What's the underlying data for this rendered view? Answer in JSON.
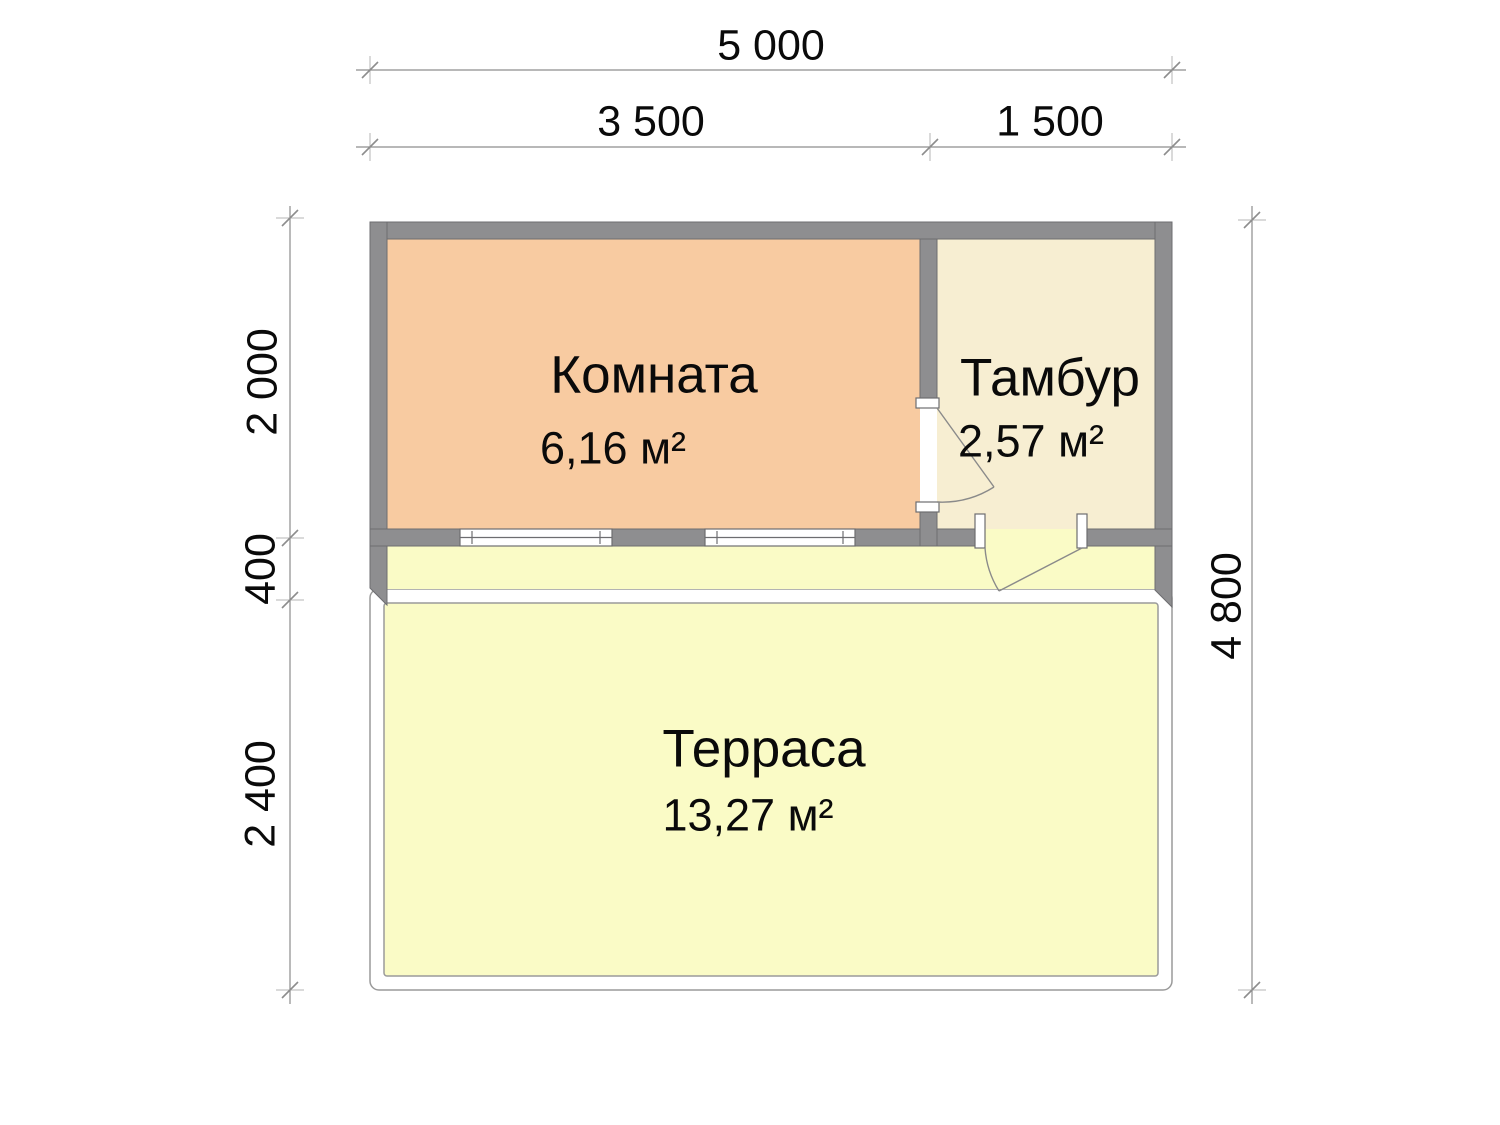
{
  "plan": {
    "title": "Floor plan with terrace",
    "rooms": [
      {
        "id": "komnata",
        "name": "Комната",
        "area": "6,16 м²"
      },
      {
        "id": "tambur",
        "name": "Тамбур",
        "area": "2,57 м²"
      },
      {
        "id": "terrasa",
        "name": "Терраса",
        "area": "13,27 м²"
      }
    ],
    "dimensions": {
      "overall_width": "5 000",
      "main_width": "3 500",
      "tambur_width": "1 500",
      "room_depth": "2 000",
      "wall_offset": "400",
      "terrace_depth": "2 400",
      "overall_depth": "4 800"
    },
    "colors": {
      "wall": "#8e8e90",
      "wall_outline": "#6d6d70",
      "room_komnata": "#f8cba1",
      "room_tambur": "#f7eed2",
      "terrace": "#fafbc6",
      "thin_line": "#9a9a9a",
      "door_line": "#8a8a8a",
      "dim_line": "#8d8d8d",
      "text": "#0a0a0a"
    }
  }
}
